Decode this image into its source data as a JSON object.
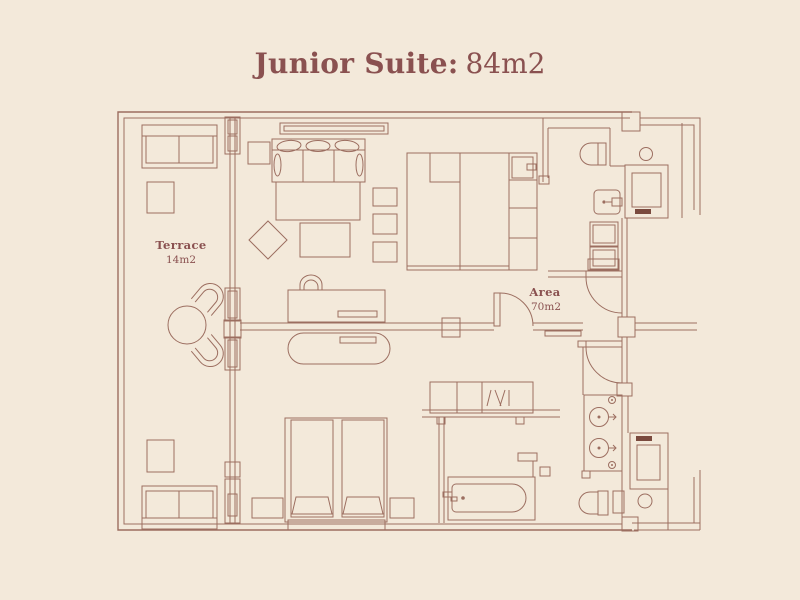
{
  "title": {
    "suite": "Junior Suite:",
    "area": "84m2"
  },
  "labels": {
    "terrace": {
      "name": "Terrace",
      "area": "14m2"
    },
    "interior": {
      "name": "Area",
      "area": "70m2"
    }
  },
  "colors": {
    "background": "#f3e9da",
    "line": "#9c6e60",
    "line-dark": "#7a4a3e",
    "text": "#8a5150"
  },
  "furniture_icons": [
    "outdoor-sofa",
    "square-table",
    "round-dining-table",
    "terrace-chair",
    "living-sofa",
    "rug",
    "coffee-table",
    "diamond-side-table",
    "stool",
    "desk",
    "desk-chair",
    "stadium-bench",
    "king-bed",
    "double-bed",
    "pillow",
    "nightstand",
    "headboard-shelf",
    "safe",
    "wardrobe",
    "curtain-box",
    "bathtub",
    "toilet",
    "washbasin",
    "double-vanity",
    "shower",
    "sliding-door",
    "swing-door",
    "glass-partition"
  ]
}
